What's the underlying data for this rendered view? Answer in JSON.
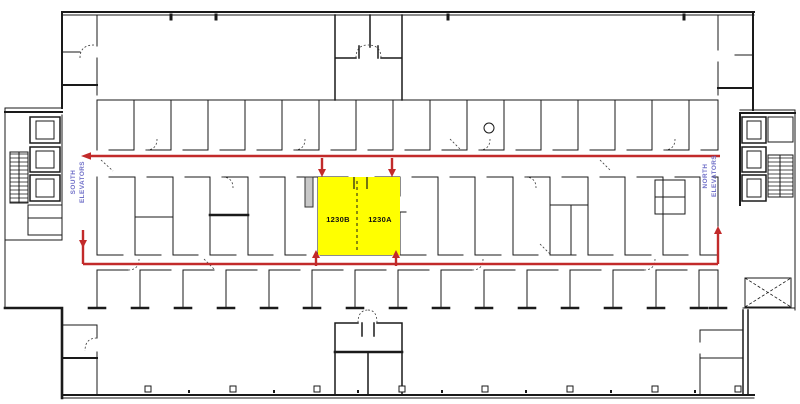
{
  "floor_plan": {
    "highlighted_room": {
      "id_b": "1230B",
      "id_a": "1230A"
    },
    "annotations": {
      "south_elevators": {
        "line1": "SOUTH",
        "line2": "ELEVATORS"
      },
      "north_elevators": {
        "line1": "NORTH",
        "line2": "ELEVATORS"
      }
    },
    "colors": {
      "highlight_fill": "#FFFF00",
      "route_red": "#C22A2A",
      "elevator_label_blue": "#7070C8",
      "wall_black": "#1A1A1A",
      "background": "#FFFFFF"
    }
  }
}
